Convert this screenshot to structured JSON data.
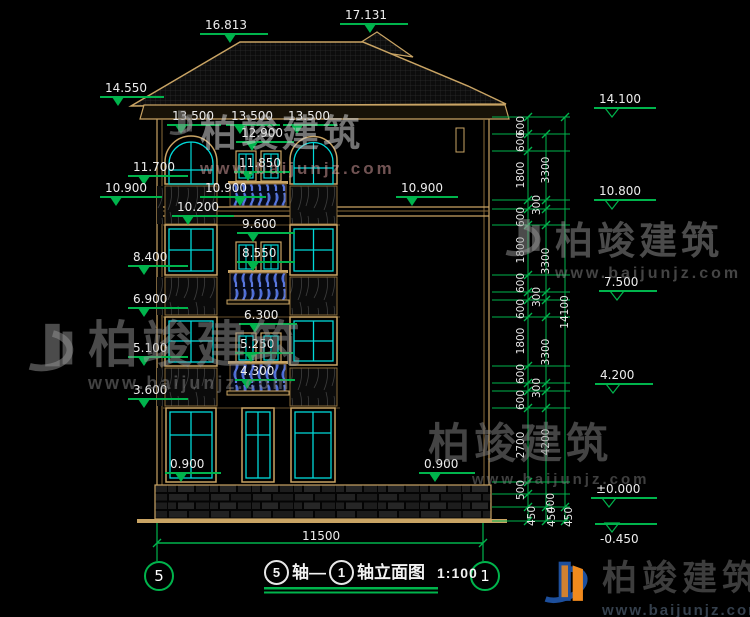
{
  "drawing_title": {
    "start_axis": "5",
    "seg1": "轴—",
    "end_axis": "1",
    "seg2": "轴立面图",
    "scale": "1:100"
  },
  "axis_bubbles": {
    "left": "5",
    "right": "1"
  },
  "bottom_dimension": "11500",
  "elevation_markers": [
    "16.813",
    "17.131",
    "14.550",
    "13.500",
    "13.500",
    "13.500",
    "12.900",
    "11.850",
    "11.700",
    "10.900",
    "10.900",
    "10.900",
    "10.200",
    "9.600",
    "8.550",
    "8.400",
    "6.900",
    "6.300",
    "5.250",
    "5.100",
    "4.300",
    "3.600",
    "0.900",
    "0.900",
    "14.100",
    "10.800",
    "7.500",
    "4.200",
    "±0.000",
    "-0.450"
  ],
  "dimensions": [
    "600",
    "600",
    "1800",
    "300",
    "600",
    "1800",
    "600",
    "300",
    "600",
    "1800",
    "600",
    "300",
    "600",
    "2700",
    "500",
    "400",
    "450",
    "3300",
    "3300",
    "3300",
    "4200",
    "450",
    "14100",
    "450"
  ],
  "watermark": {
    "brand": "柏竣建筑",
    "url": "www.baijunjz.com"
  },
  "colors": {
    "dimension_green": "#00b44c",
    "window_cyan": "#00d9d9",
    "facade_tan": "#c9a464",
    "baluster_blue": "#4a6ad8",
    "logo_blue": "#1d4f9c",
    "logo_orange": "#f08a1d"
  }
}
